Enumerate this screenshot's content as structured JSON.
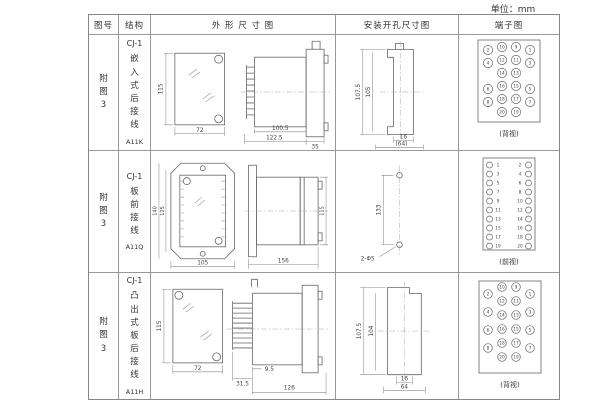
{
  "unit_label": "单位：mm",
  "header": {
    "figure": "图号",
    "structure": "结构",
    "outline": "外 形 尺 寸 图",
    "mounting": "安装开孔尺寸图",
    "terminal": "端子图"
  },
  "rows": [
    {
      "figure": "附图3",
      "model": "CJ-1",
      "desc": "嵌入式后接线",
      "code": "A11K",
      "outline": {
        "front_h": "115",
        "front_w": "72",
        "body_d": "100.5",
        "overall_d": "122.5",
        "flange_d": "35"
      },
      "mounting": {
        "outer_h": "107.5",
        "inner_h": "105",
        "slot_w": "16",
        "overall_w": "(64)"
      },
      "terminal": {
        "caption": "(背视)",
        "outer_left": [
          "2",
          "4",
          "6",
          "8"
        ],
        "inner_left": [
          "10",
          "12",
          "14",
          "16",
          "18",
          "20"
        ],
        "inner_right": [
          "9",
          "11",
          "13",
          "15",
          "17",
          "19"
        ],
        "outer_right": [
          "1",
          "3",
          "5",
          "7"
        ]
      }
    },
    {
      "figure": "附图3",
      "model": "CJ-1",
      "desc": "板前接线",
      "code": "A11Q",
      "outline": {
        "outer_h": "140",
        "inner_h": "125",
        "front_w": "105",
        "side_d": "156",
        "side_h": "115"
      },
      "mounting": {
        "hole_span": "133",
        "holes": "2-Φ5"
      },
      "terminal": {
        "caption": "(前视)",
        "left": [
          "1",
          "3",
          "5",
          "7",
          "9",
          "11",
          "13",
          "15",
          "17",
          "19"
        ],
        "right": [
          "2",
          "4",
          "6",
          "8",
          "10",
          "12",
          "14",
          "16",
          "18",
          "20"
        ]
      }
    },
    {
      "figure": "附图3",
      "model": "CJ-1",
      "desc": "凸出式板后接线",
      "code": "A11H",
      "outline": {
        "front_h": "115",
        "front_w": "72",
        "pin_d": "31.5",
        "gap_d": "9.5",
        "overall_d": "126"
      },
      "mounting": {
        "outer_h": "107.5",
        "inner_h": "104",
        "slot_w": "16",
        "overall_w": "64"
      },
      "terminal": {
        "caption": "(背视)",
        "outer_left": [
          "2",
          "4",
          "6",
          "8"
        ],
        "inner_left": [
          "10",
          "12",
          "14",
          "16",
          "18",
          "20"
        ],
        "inner_right": [
          "9",
          "11",
          "13",
          "15",
          "17",
          "19"
        ],
        "outer_right": [
          "1",
          "3",
          "5",
          "7"
        ]
      }
    }
  ]
}
